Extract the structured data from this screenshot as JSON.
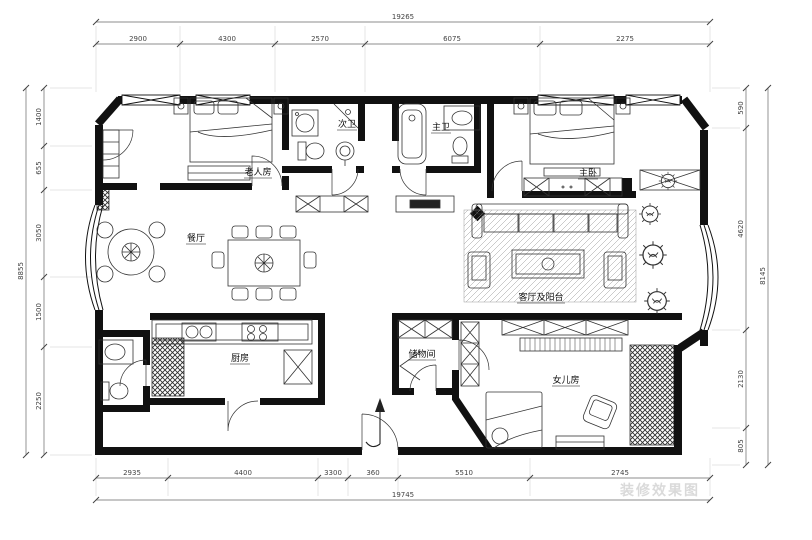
{
  "document": {
    "type": "residential-floor-plan",
    "language": "zh-CN"
  },
  "rooms": {
    "elder_bedroom": {
      "label": "老人房"
    },
    "second_bathroom": {
      "label": "次卫"
    },
    "master_bathroom": {
      "label": "主卫"
    },
    "master_bedroom": {
      "label": "主卧"
    },
    "dining_room": {
      "label": "餐厅"
    },
    "living_room": {
      "label": "客厅及阳台"
    },
    "kitchen": {
      "label": "厨房"
    },
    "storage_room": {
      "label": "储物间"
    },
    "daughter_room": {
      "label": "女儿房"
    }
  },
  "dimensions": {
    "top": {
      "total": "19265",
      "segments": [
        "2900",
        "4300",
        "2570",
        "6075",
        "2275"
      ]
    },
    "bottom": {
      "total": "19745",
      "segments": [
        "2935",
        "4400",
        "3300",
        "360",
        "5510",
        "2745"
      ]
    },
    "left": {
      "total": "8855",
      "segments": [
        "1400",
        "655",
        "3050",
        "1500",
        "2250"
      ]
    },
    "right": {
      "total": "8145",
      "segments": [
        "590",
        "4620",
        "2130",
        "805"
      ]
    }
  },
  "watermark": {
    "text": "装修效果图"
  },
  "colors": {
    "wall": "#111111",
    "furniture_line": "#333333",
    "dimension_line": "#666666",
    "hatch": "#2f2f2f",
    "background": "#ffffff",
    "watermark": "#dadada"
  }
}
